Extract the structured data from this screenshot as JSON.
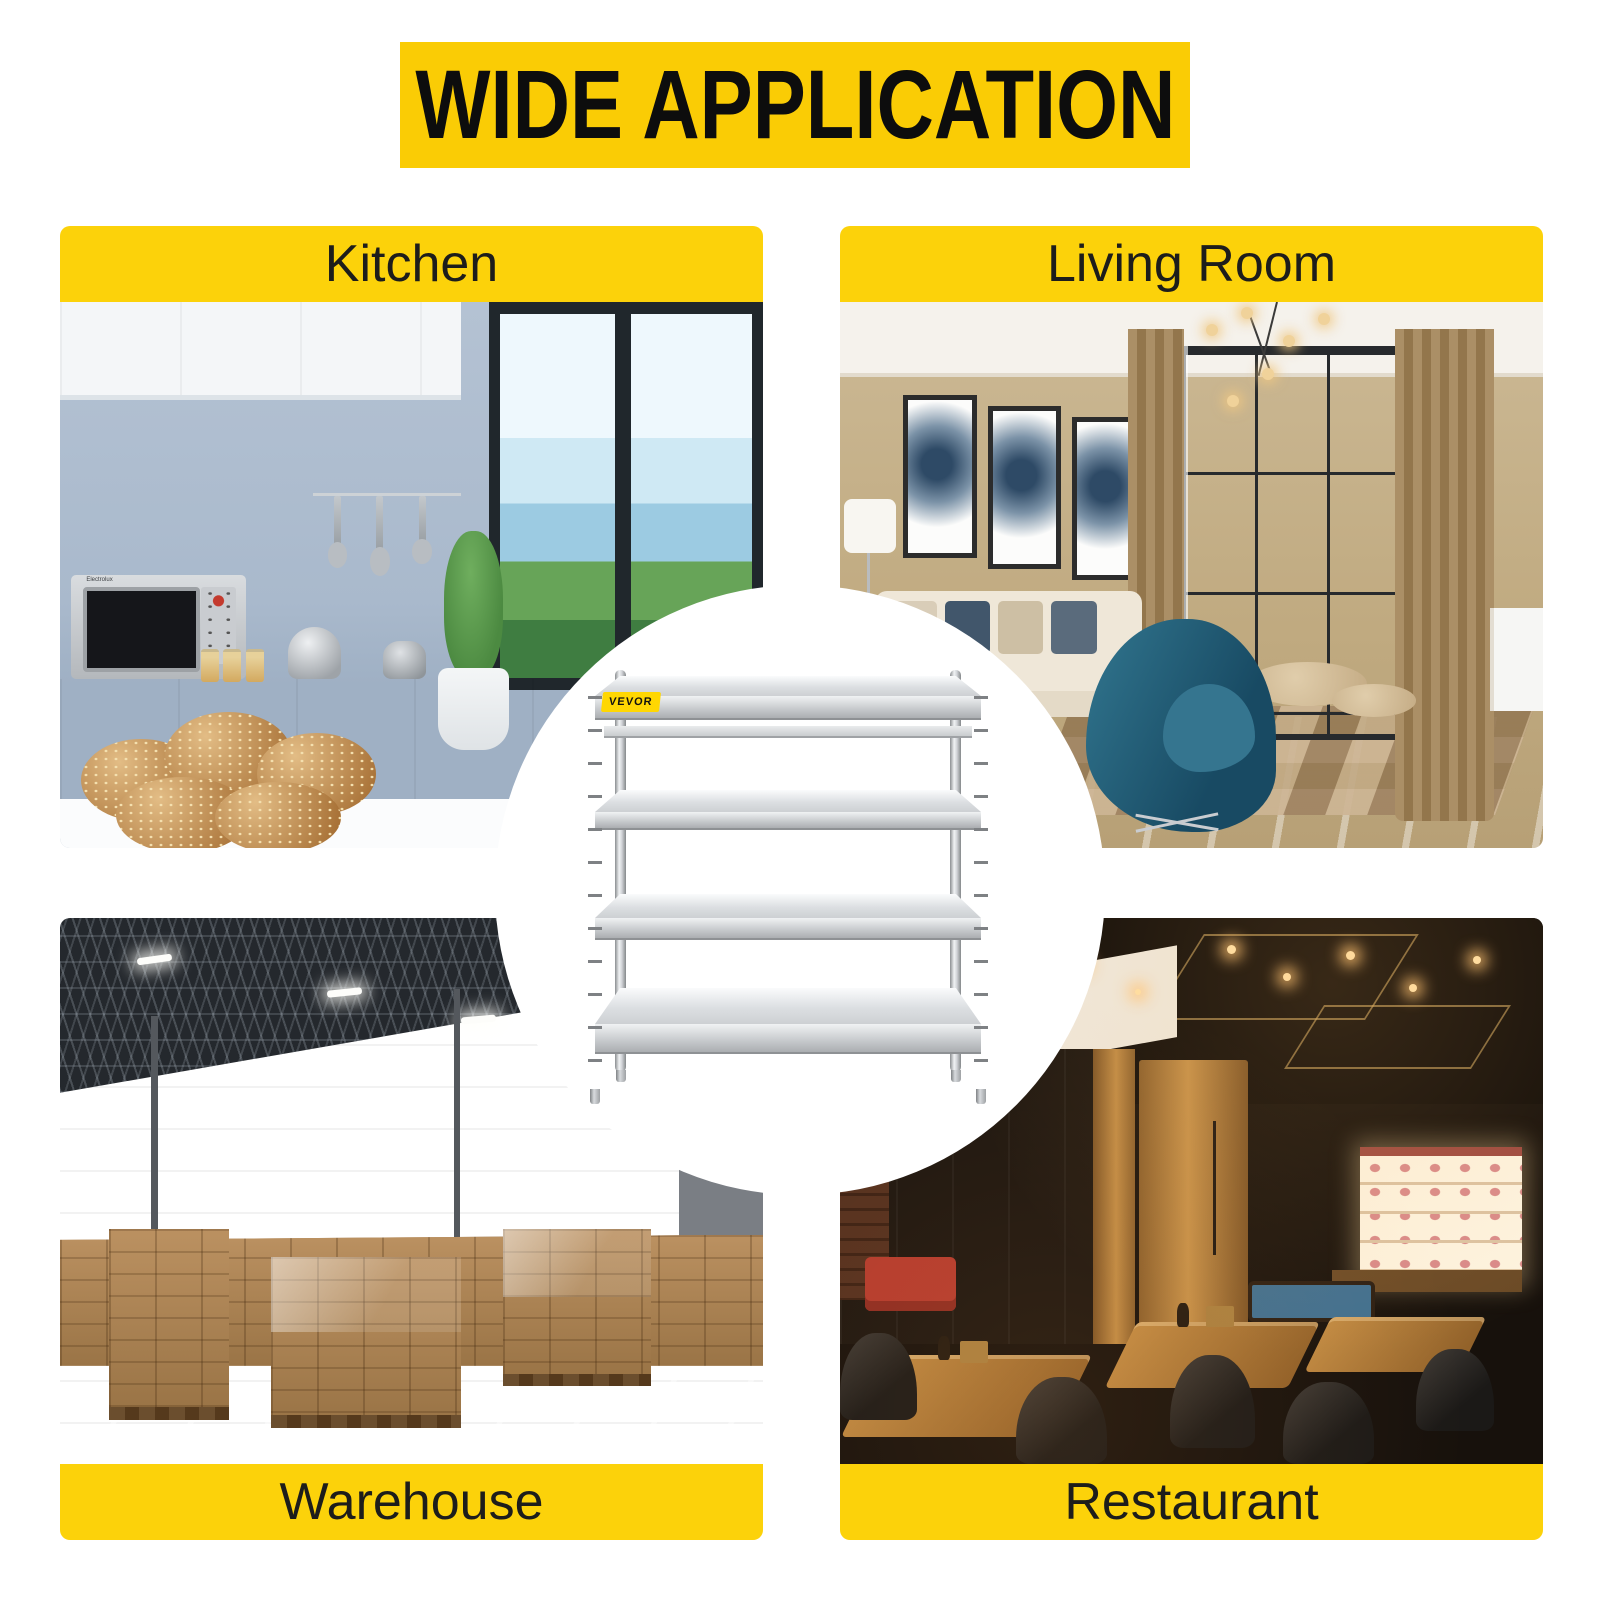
{
  "banner": {
    "title": "WIDE APPLICATION"
  },
  "colors": {
    "banner_yellow": "#FACC05",
    "band_yellow": "#FCD20A",
    "brand_yellow": "#FFD702",
    "banner_text": "#0D0D0D",
    "label_text": "#1D1D1B",
    "background": "#FFFFFF"
  },
  "quadrants": {
    "kitchen": {
      "label": "Kitchen",
      "label_position": "top",
      "photo": "kitchen-interior"
    },
    "living_room": {
      "label": "Living Room",
      "label_position": "top",
      "photo": "living-room-interior"
    },
    "warehouse": {
      "label": "Warehouse",
      "label_position": "bottom",
      "photo": "warehouse-interior"
    },
    "restaurant": {
      "label": "Restaurant",
      "label_position": "bottom",
      "photo": "restaurant-interior"
    }
  },
  "center": {
    "brand_badge": "VEVOR",
    "product_image": "4-tier-stainless-steel-shelving-unit"
  },
  "kitchen_photo_text": {
    "microwave_brand": "Electrolux"
  }
}
